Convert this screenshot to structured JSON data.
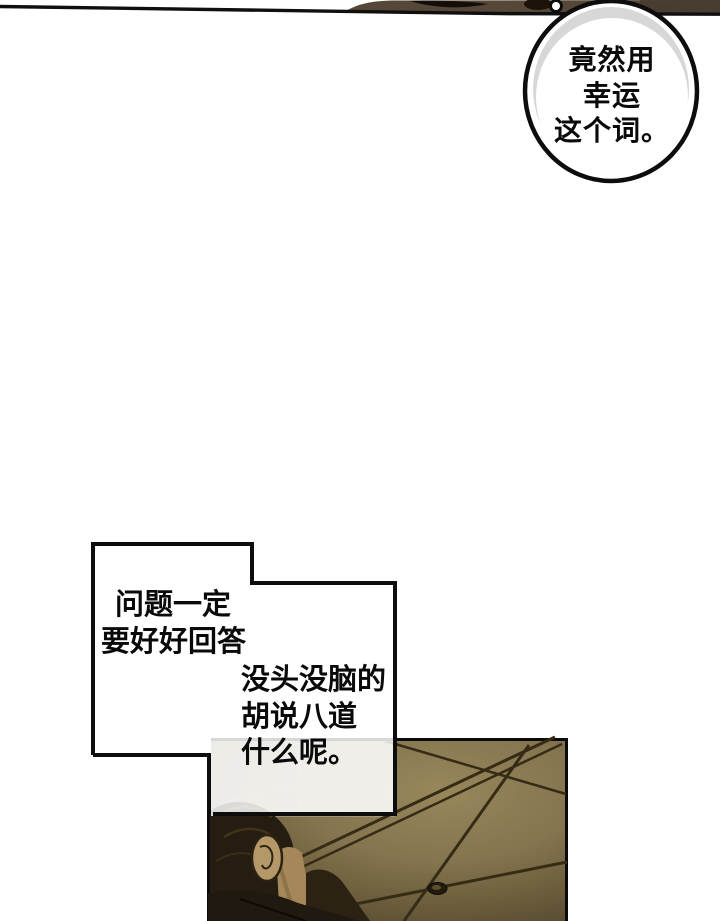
{
  "comic": {
    "speech_bubble": {
      "lines": [
        "竟然用",
        "幸运",
        "这个词。"
      ]
    },
    "caption_box": {
      "block1": [
        "问题一定",
        "要好好回答"
      ],
      "block2": [
        "没头没脑的",
        "胡说八道",
        "什么呢。"
      ]
    },
    "colors": {
      "ink": "#0b0b0b",
      "paper": "#ffffff",
      "bubble_shade": "#d7d7d7",
      "top_strip_brown": "#564838",
      "ceiling_olive": "#8a7a4c",
      "ceiling_seam": "#362c15",
      "hair_dark": "#251d11",
      "skin_tan": "#b59868",
      "clothing_dark": "#1f1910"
    }
  }
}
